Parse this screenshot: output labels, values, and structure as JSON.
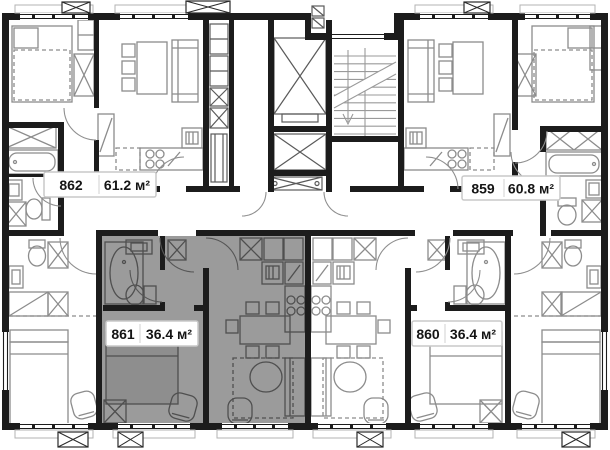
{
  "floor_plan": {
    "units": [
      {
        "number": "862",
        "area": "61.2 м²",
        "highlighted": false
      },
      {
        "number": "859",
        "area": "60.8 м²",
        "highlighted": false
      },
      {
        "number": "861",
        "area": "36.4 м²",
        "highlighted": true
      },
      {
        "number": "860",
        "area": "36.4 м²",
        "highlighted": false
      }
    ],
    "highlight_color": "#9b9b9b",
    "wall_color": "#1c1c1c",
    "background_color": "#ffffff",
    "label_border_color": "#c9c9c9"
  }
}
